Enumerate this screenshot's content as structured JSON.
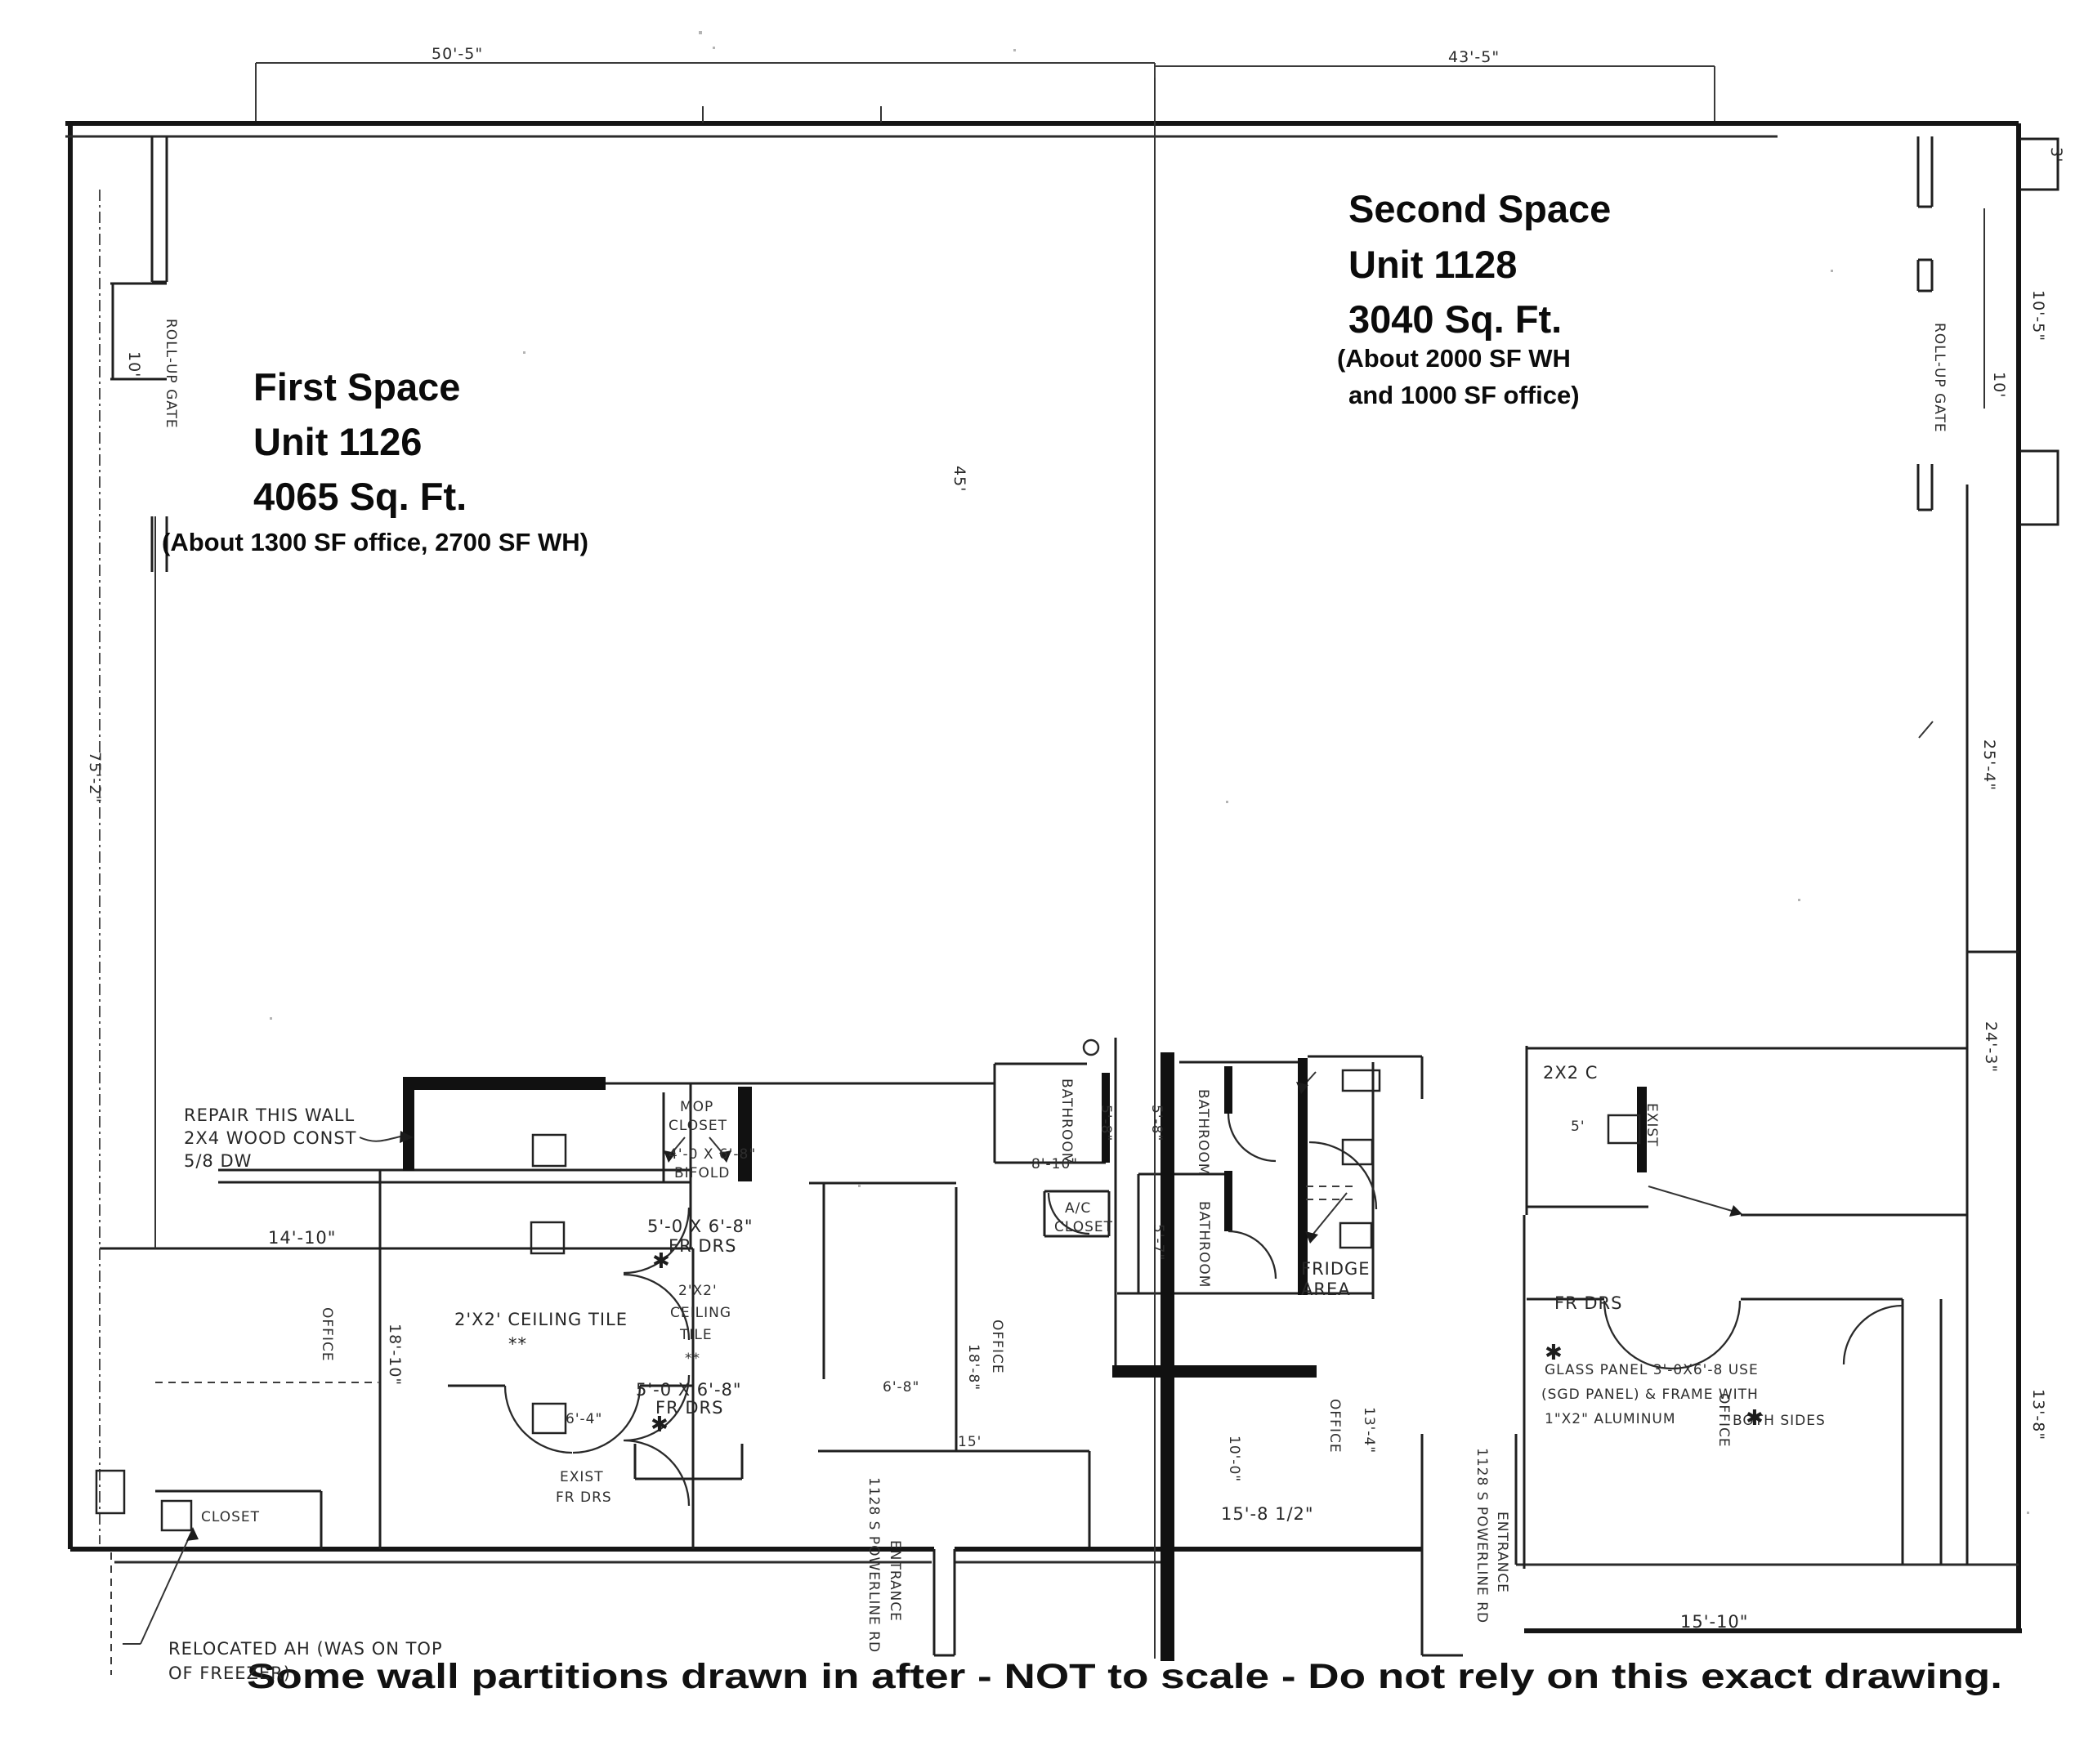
{
  "colors": {
    "paper": "#ffffff",
    "ink": "#151515",
    "scan_gray": "#555555"
  },
  "spaces": {
    "first": {
      "title": "First Space",
      "unit": "Unit 1126",
      "area": "4065 Sq. Ft.",
      "detail": "(About 1300 SF office, 2700 SF WH)"
    },
    "second": {
      "title": "Second Space",
      "unit": "Unit 1128",
      "area": "3040 Sq. Ft.",
      "detail_line1": "(About 2000 SF WH",
      "detail_line2": "and 1000 SF office)"
    }
  },
  "footer": {
    "note": "Some wall partitions drawn in after - NOT to scale - Do not rely on this exact drawing."
  },
  "labels": [
    "50'-5\"",
    "43'-5\"",
    "ROLL-UP GATE",
    "10'",
    "75'-2\"",
    "ROLL-UP GATE",
    "3'",
    "10'-5\"",
    "10'",
    "25'-4\"",
    "24'-3\"",
    "13'-8\"",
    "45'",
    "REPAIR THIS WALL",
    "2X4 WOOD CONST",
    "5/8 DW",
    "14'-10\"",
    "OFFICE",
    "18'-10\"",
    "2'X2' CEILING TILE",
    "**",
    "2'X2'",
    "CEILING",
    "TILE",
    "**",
    "MOP",
    "CLOSET",
    "4'-0 X 6'-8\"",
    "BIFOLD",
    "5'-0 X 6'-8\"",
    "FR DRS",
    "5'-0 X 6'-8\"",
    "FR DRS",
    "EXIST",
    "FR DRS",
    "6'-4\"",
    "BATHROOM",
    "5'-8\"",
    "8'-10\"",
    "A/C",
    "CLOSET",
    "BATHROOM",
    "5'-8\"",
    "BATHROOM",
    "5'-7\"",
    "OFFICE",
    "18'-8\"",
    "15'",
    "6'-8\"",
    "OFFICE",
    "13'-4\"",
    "10'-0\"",
    "15'-8 1/2\"",
    "FRIDGE",
    "AREA",
    "2X2 C",
    "5'",
    "EXIST",
    "FR DRS",
    "GLASS PANEL 3'-0X6'-8 USE",
    "(SGD PANEL) & FRAME WITH",
    "1\"X2\" ALUMINUM",
    "BOTH SIDES",
    "OFFICE",
    "ENTRANCE",
    "1128 S POWERLINE RD",
    "ENTRANCE",
    "1128 S POWERLINE RD",
    "15'-10\"",
    "CLOSET",
    "RELOCATED AH (WAS ON TOP",
    "OF FREEZER)",
    "✱",
    "✱",
    "✱",
    "✱"
  ]
}
